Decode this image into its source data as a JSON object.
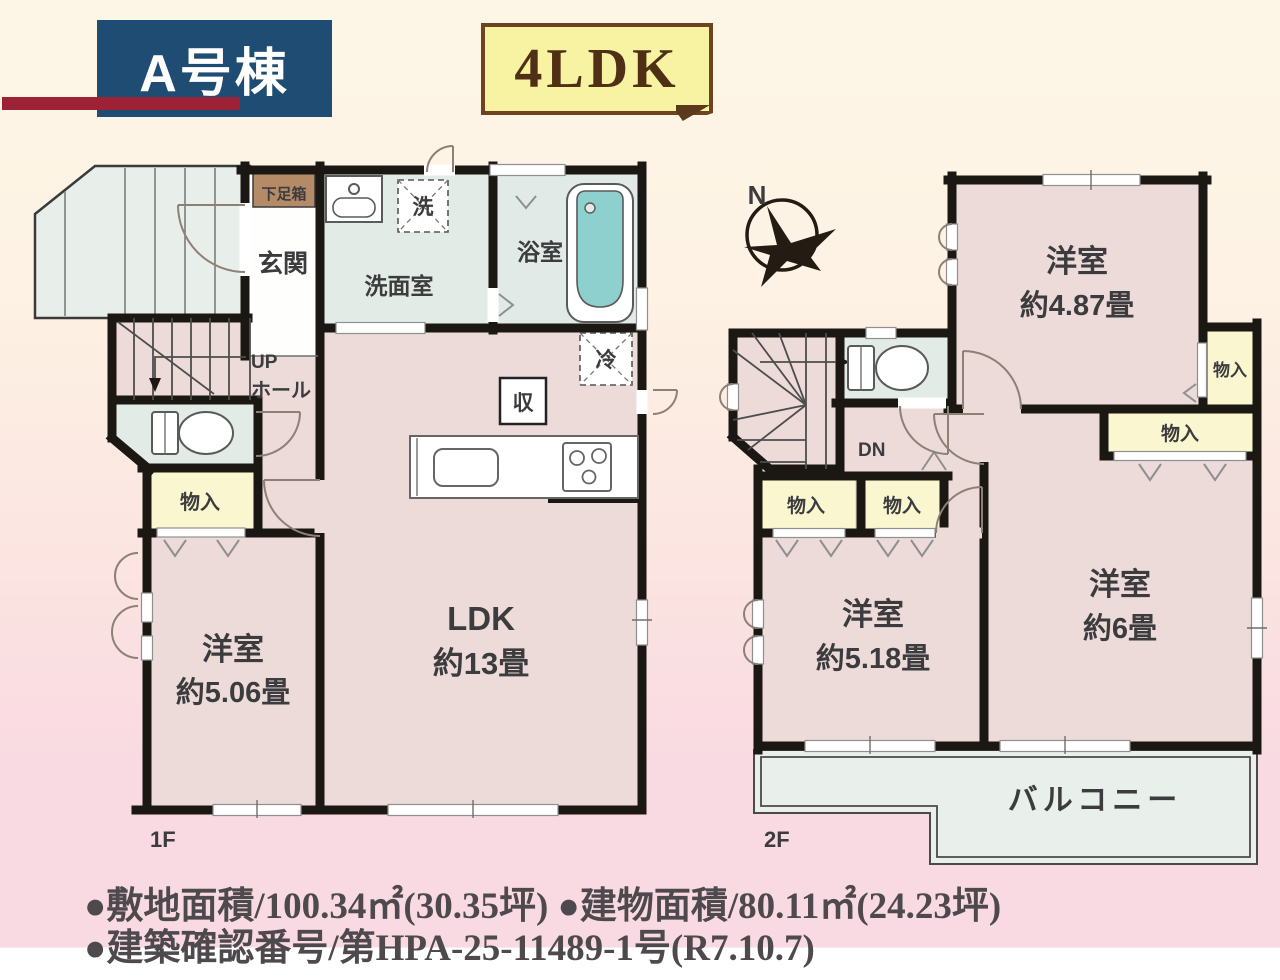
{
  "header": {
    "building": "A号棟",
    "layout": "4LDK"
  },
  "floor1": {
    "label": "1F",
    "shoe_box": "下足箱",
    "entrance": "玄関",
    "washroom": "洗面室",
    "washer": "洗",
    "bathroom": "浴室",
    "up": "UP",
    "hall": "ホール",
    "closet": "物入",
    "fridge": "冷",
    "storage": "収",
    "room1_name": "洋室",
    "room1_size": "約5.06畳",
    "ldk_name": "LDK",
    "ldk_size": "約13畳"
  },
  "floor2": {
    "label": "2F",
    "north": "N",
    "down": "DN",
    "room1_name": "洋室",
    "room1_size": "約4.87畳",
    "room2_name": "洋室",
    "room2_size": "約5.18畳",
    "room3_name": "洋室",
    "room3_size": "約6畳",
    "closet_side": "物入",
    "closet_wide": "物入",
    "closet_a": "物入",
    "closet_b": "物入",
    "balcony": "バルコニー"
  },
  "footer": {
    "line1": "●敷地面積/100.34㎡(30.35坪) ●建物面積/80.11㎡(24.23坪)",
    "line2": "●建築確認番号/第HPA-25-11489-1号(R7.10.7)"
  },
  "colors": {
    "building_badge_bg": "#1e4c72",
    "building_badge_underline": "#9d2235",
    "layout_badge_bg": "#f8f2a3",
    "layout_badge_border": "#6d441f",
    "room_pink": "#ecdbd9",
    "wet_area_green": "#e3ebe6",
    "closet_yellow": "#faf6cf",
    "balcony_gray": "#e9efeb",
    "bathtub_teal": "#8ed0cd",
    "shoe_box_brown": "#b58b67",
    "wall_black": "#1b1713"
  }
}
